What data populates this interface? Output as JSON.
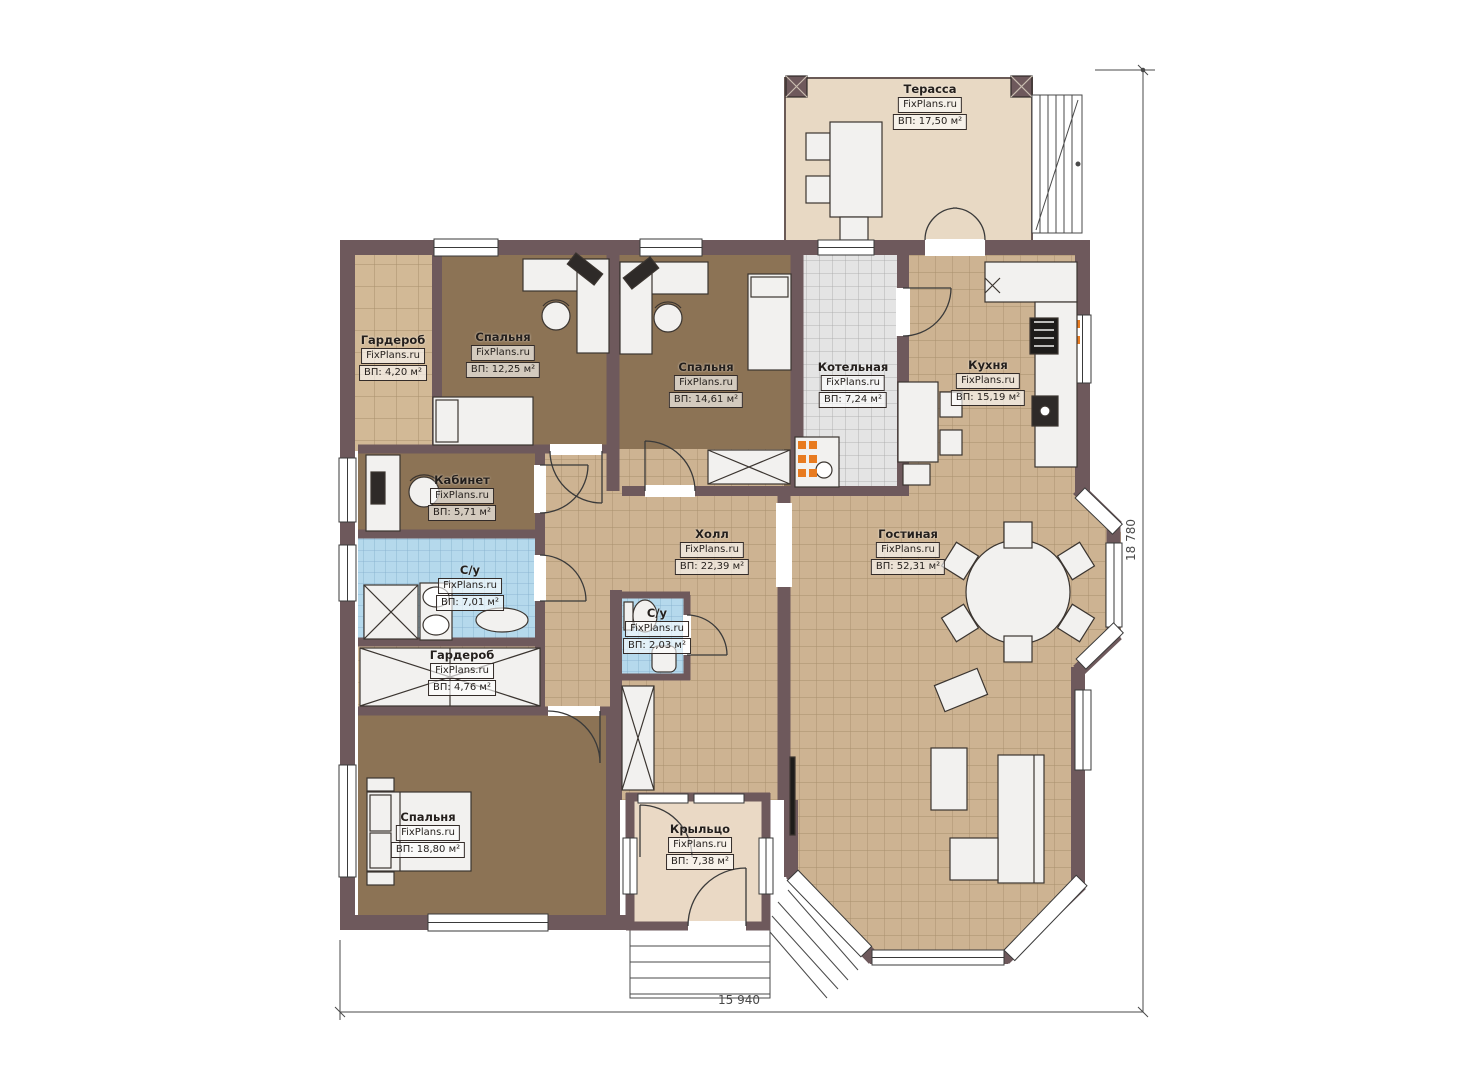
{
  "plan": {
    "brand": "FixPlans.ru",
    "rooms": [
      {
        "id": "terrace",
        "name": "Терасса",
        "brand": "FixPlans.ru",
        "area": "ВП: 17,50 м²"
      },
      {
        "id": "wardrobe-top",
        "name": "Гардероб",
        "brand": "FixPlans.ru",
        "area": "ВП: 4,20 м²"
      },
      {
        "id": "bedroom-1",
        "name": "Спальня",
        "brand": "FixPlans.ru",
        "area": "ВП: 12,25 м²"
      },
      {
        "id": "bedroom-2",
        "name": "Спальня",
        "brand": "FixPlans.ru",
        "area": "ВП: 14,61 м²"
      },
      {
        "id": "boiler",
        "name": "Котельная",
        "brand": "FixPlans.ru",
        "area": "ВП: 7,24 м²"
      },
      {
        "id": "kitchen",
        "name": "Кухня",
        "brand": "FixPlans.ru",
        "area": "ВП: 15,19 м²"
      },
      {
        "id": "office",
        "name": "Кабинет",
        "brand": "FixPlans.ru",
        "area": "ВП: 5,71 м²"
      },
      {
        "id": "bathroom-main",
        "name": "С/у",
        "brand": "FixPlans.ru",
        "area": "ВП: 7,01 м²"
      },
      {
        "id": "hall",
        "name": "Холл",
        "brand": "FixPlans.ru",
        "area": "ВП: 22,39 м²"
      },
      {
        "id": "living-room",
        "name": "Гостиная",
        "brand": "FixPlans.ru",
        "area": "ВП: 52,31 м²"
      },
      {
        "id": "bathroom-small",
        "name": "С/у",
        "brand": "FixPlans.ru",
        "area": "ВП: 2,03 м²"
      },
      {
        "id": "wardrobe-bottom",
        "name": "Гардероб",
        "brand": "FixPlans.ru",
        "area": "ВП: 4,76 м²"
      },
      {
        "id": "bedroom-3",
        "name": "Спальня",
        "brand": "FixPlans.ru",
        "area": "ВП: 18,80 м²"
      },
      {
        "id": "porch",
        "name": "Крыльцо",
        "brand": "FixPlans.ru",
        "area": "ВП: 7,38 м²"
      }
    ],
    "dimensions": {
      "width_mm": "15 940",
      "height_mm": "18 780"
    },
    "colors": {
      "wall": "#6e595c",
      "tile_beige": "#cdb392",
      "tile_blue": "#b5d9ec",
      "tile_gray": "#e4e4e4",
      "floor_brown": "#8c7355",
      "floor_terrace": "#e8d9c4",
      "radiator_orange": "#e87b20"
    }
  }
}
